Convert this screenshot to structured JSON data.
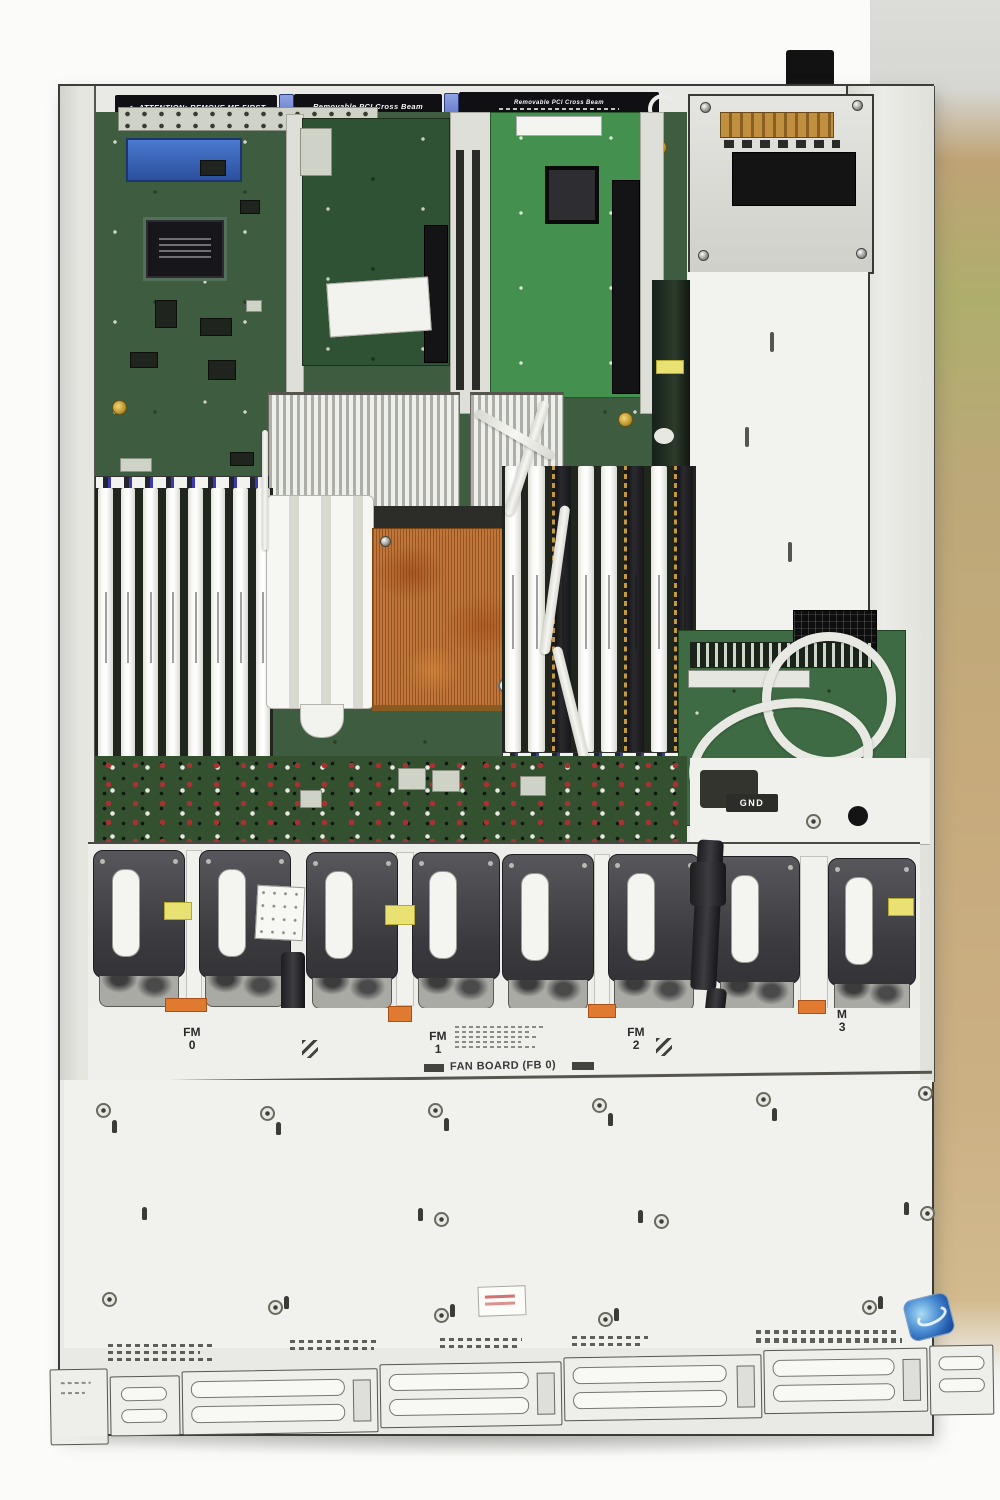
{
  "photo": {
    "subject": "Top-down photograph of an open 1U rack server chassis",
    "scene_note": "Motherboard with PCI riser cards, power supply, two DIMM banks, copper and aluminum heatsinks, eight-fan bank, and blank drive-bay cover"
  },
  "beams": {
    "left_arrow": "◄",
    "left_label": "ATTENTION:  REMOVE ME FIRST",
    "center_label": "Removable PCI Cross Beam",
    "right_label": "Removable PCI Cross Beam",
    "right_arrow": "►"
  },
  "board": {
    "gnd_label": "GND"
  },
  "fans": {
    "board_label": "FAN BOARD (FB 0)",
    "module_count": 8,
    "module_labels": [
      {
        "top": "FM",
        "bottom": "0"
      },
      {
        "top": "FM",
        "bottom": "1"
      },
      {
        "top": "FM",
        "bottom": "2"
      },
      {
        "top": "M",
        "bottom": "3"
      }
    ]
  },
  "memory": {
    "left_bank_slots": 8,
    "right_bank_slots": 8
  },
  "colors": {
    "pcb_green": "#3d5c40",
    "riser_green_bright": "#43904f",
    "riser_green_dark": "#2e5233",
    "copper_heatsink": "#bf7638",
    "aluminum_heatsink": "#c9c9c4",
    "fan_body": "#3f3f44",
    "chassis_metal": "#ededea",
    "backdrop_beige": "#c3a87a",
    "cpu_sticker_blue": "#2f6fc0"
  }
}
